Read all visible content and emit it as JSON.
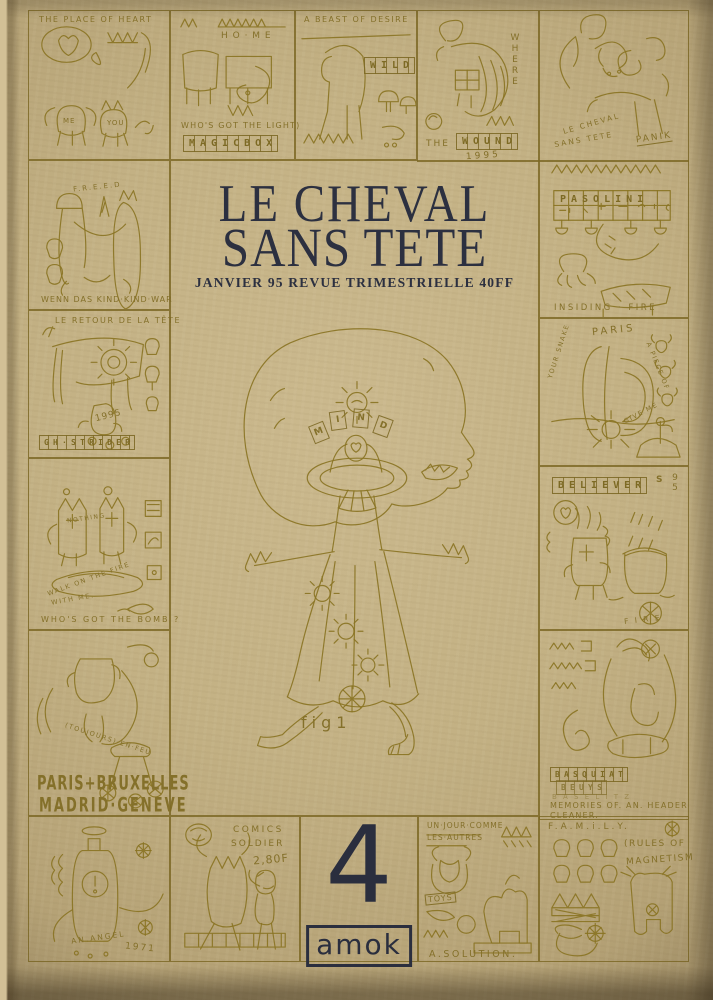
{
  "cover": {
    "title_line1": "LE CHEVAL",
    "title_line2": "SANS TETE",
    "subtitle": "JANVIER 95 REVUE TRIMESTRIELLE 40FF",
    "issue_number": "4",
    "publisher": "amok",
    "figure_caption": "fig1",
    "mind": {
      "m": "M",
      "i": "I",
      "n": "N",
      "d": "D"
    },
    "colors": {
      "paper": "#c3b184",
      "ink": "#8a7424",
      "print_navy": "#2c3040"
    }
  },
  "panels": {
    "place_of_heart": {
      "title": "THE PLACE OF HEART",
      "me": "ME",
      "you": "YOU"
    },
    "home": {
      "title": "H O · M E",
      "caption": "WHO'S GOT THE LIGHT)",
      "letters": "MAGICBOX"
    },
    "beast": {
      "title": "A BEAST OF DESIRE",
      "letters": "WILD"
    },
    "wound": {
      "side_word": "WHERE",
      "prefix": "THE",
      "letters": "WOUND",
      "year": "1995"
    },
    "panik": {
      "arc1": "LE CHEVAL",
      "arc2": "SANS TETE",
      "label": "PANIK"
    },
    "freed": {
      "title": "F.R.E.E.D",
      "caption": "WENN DAS KIND·KIND·WAR"
    },
    "retour": {
      "title": "LE RETOUR DE LA TÊTE",
      "year": "1995",
      "letters": "GH·STRIDER"
    },
    "bomb": {
      "label": "NOTHING",
      "arc1": "WALK ON THE FIRE",
      "arc2": "WITH ME.",
      "caption": "WHO'S GOT THE BOMB ?"
    },
    "cities": {
      "arc": "(TOUJOURS)·EN·FEU",
      "line1": "PARIS+BRUXELLES",
      "line2": "MADRID·GENEVE"
    },
    "pasolini": {
      "letters": "PASOLINI",
      "caption": "INSIDING · FIRE"
    },
    "paris_snake": {
      "title": "PARIS",
      "left": "YOUR SNAKE",
      "right": "A PIECE OF",
      "bottom": "GIVE ME"
    },
    "believers": {
      "letters": "BELIEVER",
      "tail": "S",
      "year": "95",
      "fire": "F I R E"
    },
    "memories": {
      "row1": "BASQUIAT",
      "row2": "BEUYS",
      "row3": "B A S E L I T Z",
      "caption1": "MEMORIES OF. AN. HEADER",
      "caption2": "CLEANER."
    },
    "angel": {
      "label": "AN.ANGEL",
      "year": "1971"
    },
    "comics": {
      "line1": "COMICS",
      "line2": "SOLDIER",
      "price": "2,80F"
    },
    "solution": {
      "line1": "UN·JOUR·COMME",
      "line2": "LES·AUTRES",
      "toys": "TOYS",
      "caption": "A.SOLUTION."
    },
    "family": {
      "title": "F.A.M.i.L.Y.",
      "caption1": "(RULES OF",
      "caption2": "MAGNETISM"
    }
  }
}
